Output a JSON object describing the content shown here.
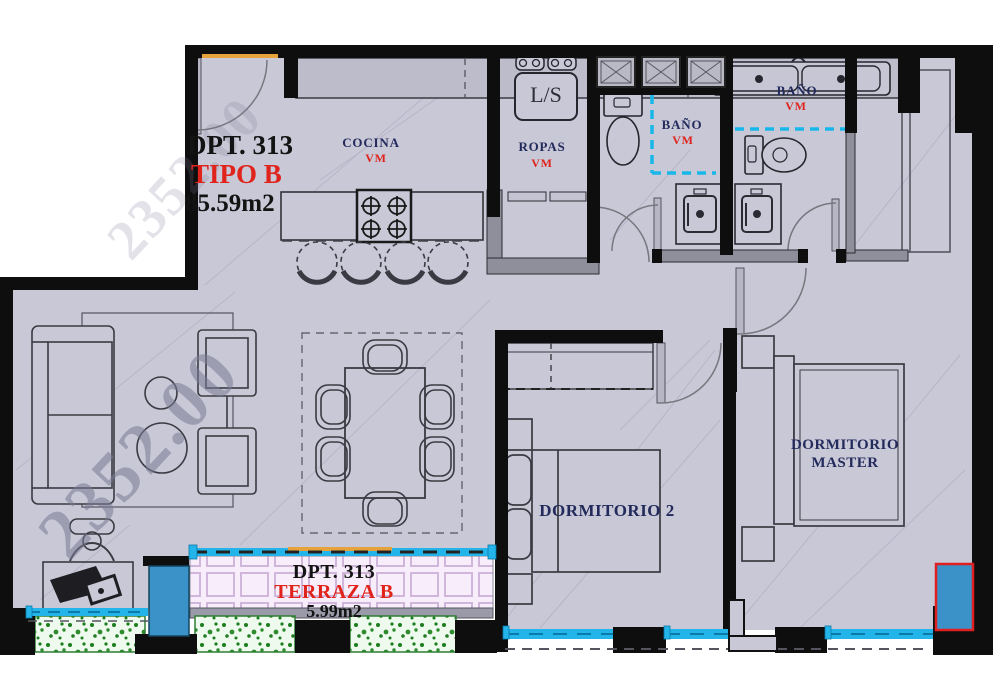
{
  "unit": {
    "number": "DPT. 313",
    "type": "TIPO B",
    "area": "85.59m2"
  },
  "rooms": {
    "cocina": {
      "name": "COCINA",
      "finish": "VM"
    },
    "ropas": {
      "name": "ROPAS",
      "finish": "VM"
    },
    "bano_secundario": {
      "name": "BAÑO",
      "finish": "VM"
    },
    "bano_master": {
      "name": "BAÑO",
      "finish": "VM"
    },
    "dormitorio2": {
      "name": "DORMITORIO 2"
    },
    "dormitorio_master": {
      "name_line1": "DORMITORIO",
      "name_line2": "MASTER"
    }
  },
  "terraza": {
    "unit": "DPT. 313",
    "name": "TERRAZA B",
    "area": "5.99m2"
  },
  "appliances": {
    "laundry": "L/S"
  },
  "watermark": "2352.00",
  "colors": {
    "floor": "#c8c8d7",
    "wall": "#0e0e0e",
    "label_navy": "#232a5c",
    "label_red": "#e0241c",
    "window_cyan": "#23b5ea",
    "glass_blue": "#3b92c8",
    "terrace_tile": "#f8eefb",
    "planter_green": "#1c7d1e",
    "corner_window_red": "#e02020",
    "threshold_orange": "#e8a23c"
  }
}
